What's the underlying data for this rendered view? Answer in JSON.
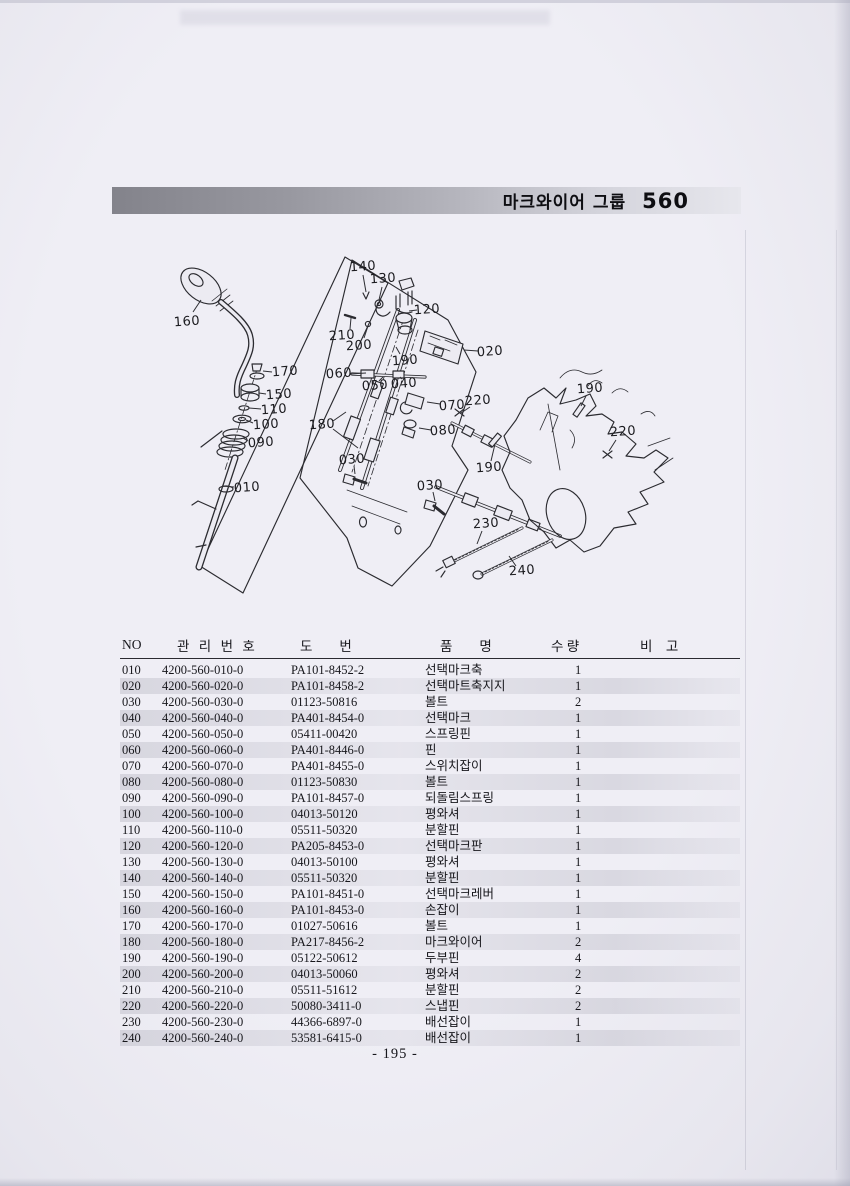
{
  "header": {
    "title_group": "마크와이어 그룹",
    "title_number": "560"
  },
  "footer": {
    "page_number": "- 195 -"
  },
  "diagram": {
    "name": "select-mark-wire-exploded-view",
    "callouts": [
      {
        "label": "160",
        "x": 187,
        "y": 322,
        "leaders": [
          [
            193,
            312,
            201,
            300
          ]
        ]
      },
      {
        "label": "170",
        "x": 285,
        "y": 372,
        "leaders": [
          [
            272,
            372,
            263,
            371
          ]
        ]
      },
      {
        "label": "150",
        "x": 279,
        "y": 395,
        "leaders": [
          [
            266,
            394,
            259,
            393
          ]
        ]
      },
      {
        "label": "110",
        "x": 274,
        "y": 410,
        "leaders": [
          [
            261,
            409,
            249,
            408
          ]
        ]
      },
      {
        "label": "100",
        "x": 266,
        "y": 425,
        "leaders": [
          [
            253,
            423,
            246,
            420
          ]
        ]
      },
      {
        "label": "090",
        "x": 261,
        "y": 443,
        "leaders": [
          [
            248,
            441,
            243,
            438
          ]
        ]
      },
      {
        "label": "010",
        "x": 247,
        "y": 488,
        "leaders": [
          [
            234,
            487,
            222,
            486
          ]
        ]
      },
      {
        "label": "140",
        "x": 363,
        "y": 267,
        "leaders": [
          [
            363,
            275,
            366,
            292
          ]
        ]
      },
      {
        "label": "130",
        "x": 383,
        "y": 279,
        "leaders": [
          [
            382,
            287,
            379,
            300
          ]
        ]
      },
      {
        "label": "120",
        "x": 427,
        "y": 310,
        "leaders": [
          [
            417,
            310,
            409,
            311
          ]
        ]
      },
      {
        "label": "210",
        "x": 342,
        "y": 336,
        "leaders": [
          [
            350,
            329,
            351,
            318
          ]
        ]
      },
      {
        "label": "200",
        "x": 359,
        "y": 346,
        "leaders": [
          [
            364,
            338,
            368,
            326
          ]
        ]
      },
      {
        "label": "020",
        "x": 490,
        "y": 352,
        "leaders": [
          [
            478,
            351,
            464,
            350
          ]
        ]
      },
      {
        "label": "190",
        "x": 405,
        "y": 361,
        "leaders": [
          [
            400,
            354,
            396,
            347
          ]
        ]
      },
      {
        "label": "060",
        "x": 339,
        "y": 374,
        "leaders": [
          [
            350,
            374,
            366,
            373
          ]
        ]
      },
      {
        "label": "050",
        "x": 375,
        "y": 386,
        "leaders": [
          [
            379,
            381,
            383,
            377
          ]
        ]
      },
      {
        "label": "040",
        "x": 404,
        "y": 384,
        "leaders": [
          [
            402,
            379,
            400,
            377
          ]
        ]
      },
      {
        "label": "070",
        "x": 452,
        "y": 406,
        "leaders": [
          [
            440,
            404,
            427,
            402
          ]
        ]
      },
      {
        "label": "080",
        "x": 443,
        "y": 431,
        "leaders": [
          [
            431,
            430,
            419,
            428
          ]
        ]
      },
      {
        "label": "180",
        "x": 322,
        "y": 425,
        "leaders": [
          [
            333,
            421,
            346,
            412
          ],
          [
            333,
            429,
            358,
            448
          ]
        ]
      },
      {
        "label": "030",
        "x": 352,
        "y": 460,
        "leaders": [
          [
            354,
            466,
            355,
            474
          ]
        ]
      },
      {
        "label": "030",
        "x": 430,
        "y": 486,
        "leaders": [
          [
            433,
            492,
            435,
            501
          ]
        ]
      },
      {
        "label": "190",
        "x": 489,
        "y": 468,
        "leaders": [
          [
            491,
            461,
            495,
            444
          ]
        ]
      },
      {
        "label": "220",
        "x": 478,
        "y": 401,
        "leaders": [
          [
            470,
            407,
            461,
            413
          ]
        ]
      },
      {
        "label": "190",
        "x": 590,
        "y": 389,
        "leaders": [
          [
            586,
            396,
            581,
            406
          ]
        ]
      },
      {
        "label": "220",
        "x": 623,
        "y": 432,
        "leaders": [
          [
            616,
            440,
            609,
            451
          ]
        ]
      },
      {
        "label": "230",
        "x": 486,
        "y": 524,
        "leaders": [
          [
            482,
            531,
            477,
            544
          ]
        ]
      },
      {
        "label": "240",
        "x": 522,
        "y": 571,
        "leaders": [
          [
            516,
            566,
            509,
            556
          ]
        ]
      }
    ]
  },
  "table": {
    "keys": [
      "no",
      "mgmt",
      "dwg",
      "name",
      "qty",
      "note"
    ],
    "columns": [
      "NO",
      "관 리 번 호",
      "도  번",
      "품  명",
      "수 량",
      "비 고"
    ],
    "rows": [
      {
        "no": "010",
        "mgmt": "4200-560-010-0",
        "dwg": "PA101-8452-2",
        "name": "선택마크축",
        "qty": "1",
        "note": ""
      },
      {
        "no": "020",
        "mgmt": "4200-560-020-0",
        "dwg": "PA101-8458-2",
        "name": "선택마트축지지",
        "qty": "1",
        "note": ""
      },
      {
        "no": "030",
        "mgmt": "4200-560-030-0",
        "dwg": "01123-50816",
        "name": "볼트",
        "qty": "2",
        "note": ""
      },
      {
        "no": "040",
        "mgmt": "4200-560-040-0",
        "dwg": "PA401-8454-0",
        "name": "선택마크",
        "qty": "1",
        "note": ""
      },
      {
        "no": "050",
        "mgmt": "4200-560-050-0",
        "dwg": "05411-00420",
        "name": "스프링핀",
        "qty": "1",
        "note": ""
      },
      {
        "no": "060",
        "mgmt": "4200-560-060-0",
        "dwg": "PA401-8446-0",
        "name": "핀",
        "qty": "1",
        "note": ""
      },
      {
        "no": "070",
        "mgmt": "4200-560-070-0",
        "dwg": "PA401-8455-0",
        "name": "스위치잡이",
        "qty": "1",
        "note": ""
      },
      {
        "no": "080",
        "mgmt": "4200-560-080-0",
        "dwg": "01123-50830",
        "name": "볼트",
        "qty": "1",
        "note": ""
      },
      {
        "no": "090",
        "mgmt": "4200-560-090-0",
        "dwg": "PA101-8457-0",
        "name": "되돌림스프링",
        "qty": "1",
        "note": ""
      },
      {
        "no": "100",
        "mgmt": "4200-560-100-0",
        "dwg": "04013-50120",
        "name": "평와셔",
        "qty": "1",
        "note": ""
      },
      {
        "no": "110",
        "mgmt": "4200-560-110-0",
        "dwg": "05511-50320",
        "name": "분할핀",
        "qty": "1",
        "note": ""
      },
      {
        "no": "120",
        "mgmt": "4200-560-120-0",
        "dwg": "PA205-8453-0",
        "name": "선택마크판",
        "qty": "1",
        "note": ""
      },
      {
        "no": "130",
        "mgmt": "4200-560-130-0",
        "dwg": "04013-50100",
        "name": "평와셔",
        "qty": "1",
        "note": ""
      },
      {
        "no": "140",
        "mgmt": "4200-560-140-0",
        "dwg": "05511-50320",
        "name": "분할핀",
        "qty": "1",
        "note": ""
      },
      {
        "no": "150",
        "mgmt": "4200-560-150-0",
        "dwg": "PA101-8451-0",
        "name": "선택마크레버",
        "qty": "1",
        "note": ""
      },
      {
        "no": "160",
        "mgmt": "4200-560-160-0",
        "dwg": "PA101-8453-0",
        "name": "손잡이",
        "qty": "1",
        "note": ""
      },
      {
        "no": "170",
        "mgmt": "4200-560-170-0",
        "dwg": "01027-50616",
        "name": "볼트",
        "qty": "1",
        "note": ""
      },
      {
        "no": "180",
        "mgmt": "4200-560-180-0",
        "dwg": "PA217-8456-2",
        "name": "마크와이어",
        "qty": "2",
        "note": ""
      },
      {
        "no": "190",
        "mgmt": "4200-560-190-0",
        "dwg": "05122-50612",
        "name": "두부핀",
        "qty": "4",
        "note": ""
      },
      {
        "no": "200",
        "mgmt": "4200-560-200-0",
        "dwg": "04013-50060",
        "name": "평와셔",
        "qty": "2",
        "note": ""
      },
      {
        "no": "210",
        "mgmt": "4200-560-210-0",
        "dwg": "05511-51612",
        "name": "분할핀",
        "qty": "2",
        "note": ""
      },
      {
        "no": "220",
        "mgmt": "4200-560-220-0",
        "dwg": "50080-3411-0",
        "name": "스냅핀",
        "qty": "2",
        "note": ""
      },
      {
        "no": "230",
        "mgmt": "4200-560-230-0",
        "dwg": "44366-6897-0",
        "name": "배선잡이",
        "qty": "1",
        "note": ""
      },
      {
        "no": "240",
        "mgmt": "4200-560-240-0",
        "dwg": "53581-6415-0",
        "name": "배선잡이",
        "qty": "1",
        "note": ""
      }
    ]
  },
  "colors": {
    "paper": "#efeef5",
    "ink": "#17171c",
    "header_bar_dark": "#83838b",
    "header_bar_light": "#e7e7ed",
    "stripe": "rgba(146,146,160,0.26)"
  }
}
